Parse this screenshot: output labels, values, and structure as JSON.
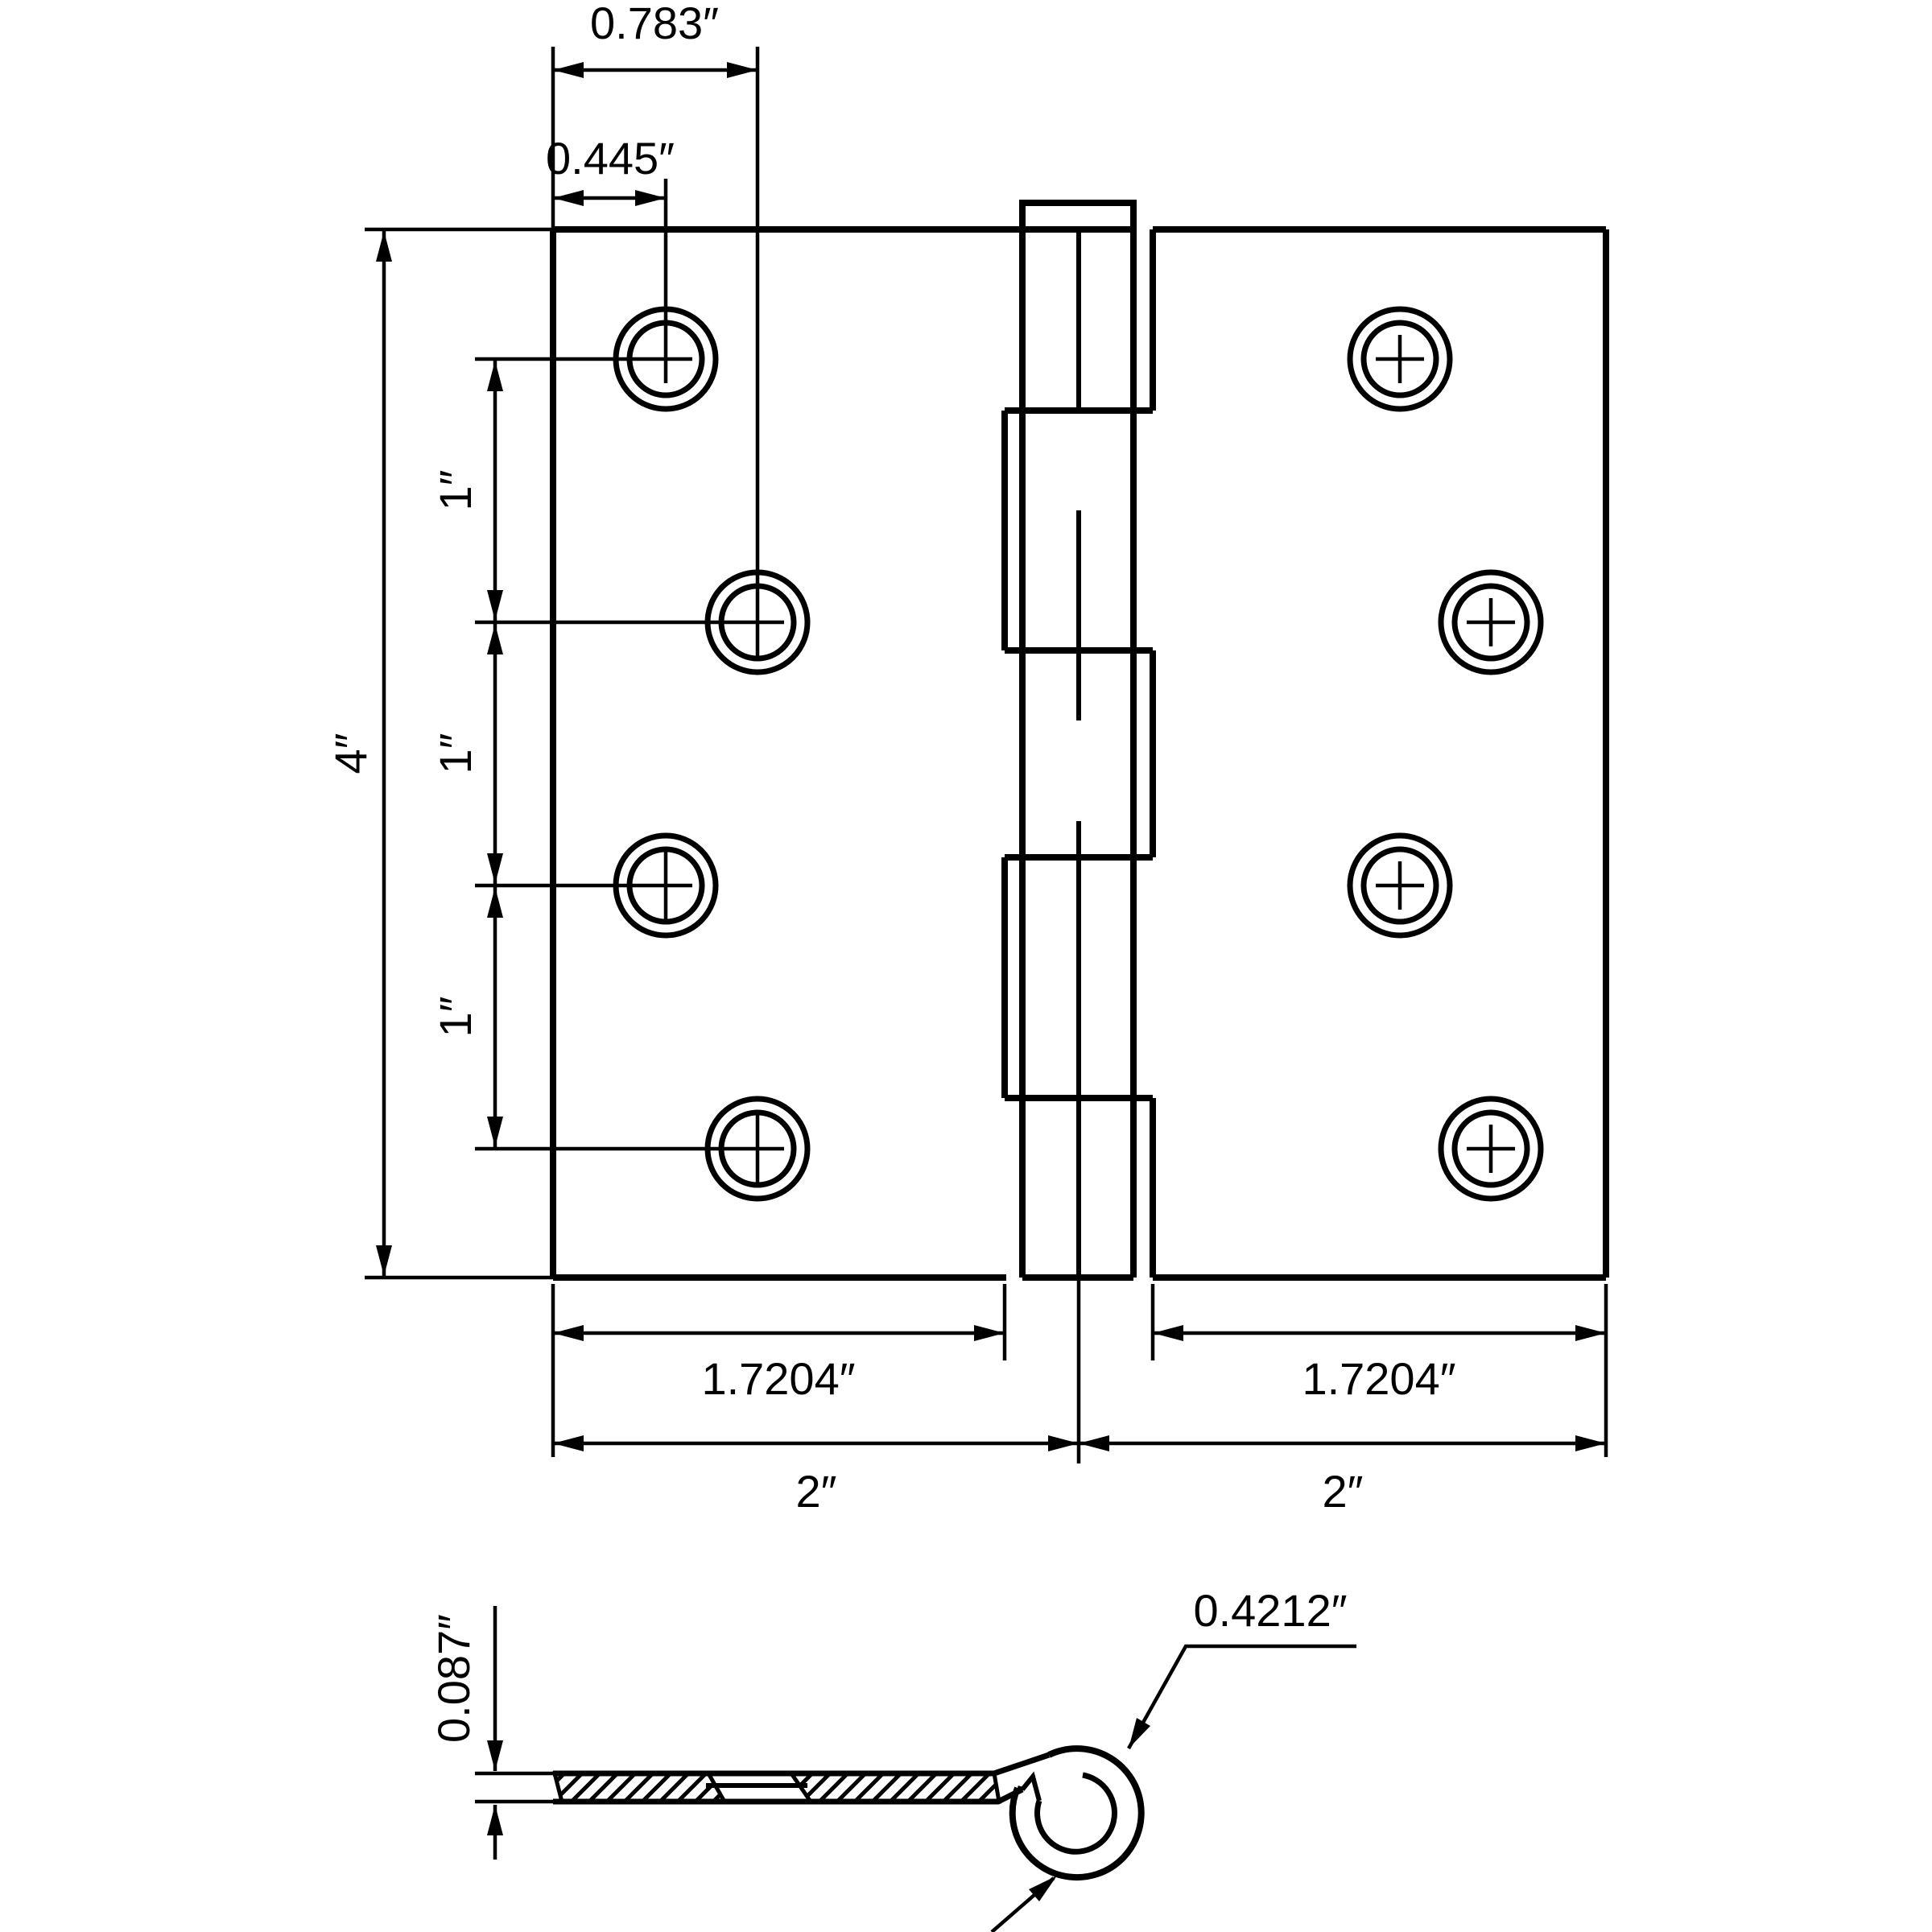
{
  "colors": {
    "ink": "#000000",
    "paper": "#ffffff"
  },
  "front_view": {
    "dim_top_outer": "0.783″",
    "dim_top_inner": "0.445″",
    "dim_height": "4″",
    "dim_spacing": [
      "1″",
      "1″",
      "1″"
    ],
    "dim_leaf_left": "1.7204″",
    "dim_leaf_right": "1.7204″",
    "dim_half_left": "2″",
    "dim_half_right": "2″"
  },
  "side_view": {
    "dim_thickness": "0.087″",
    "dim_curl": "0.4212″"
  }
}
